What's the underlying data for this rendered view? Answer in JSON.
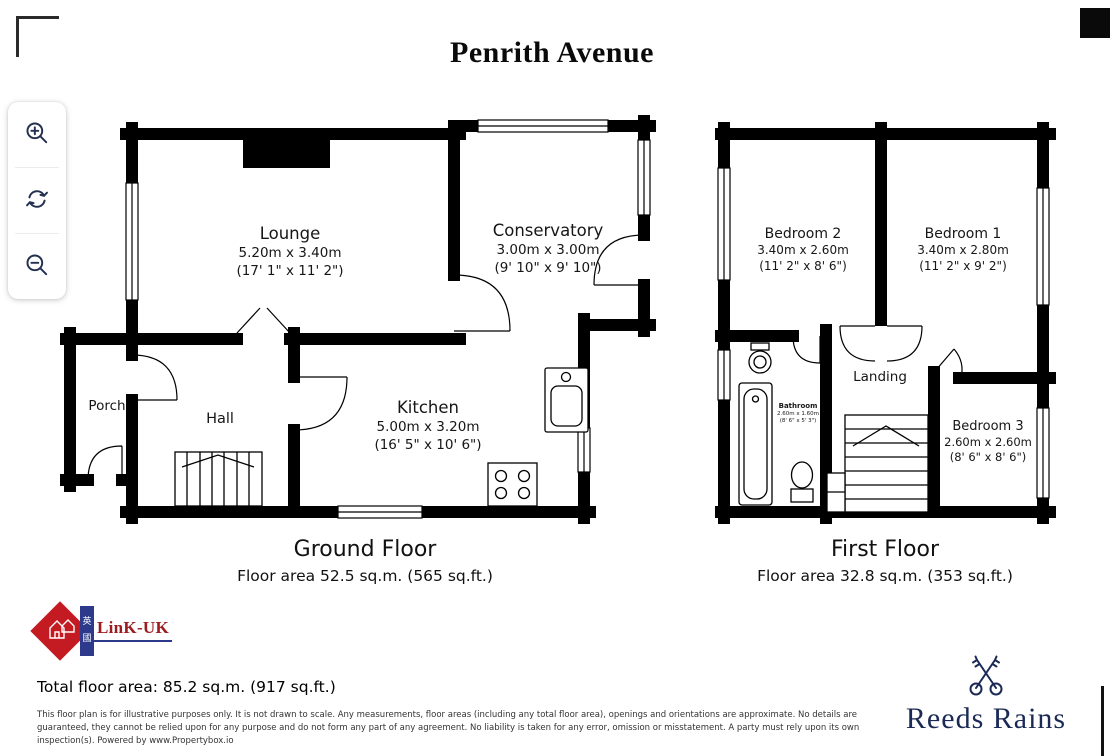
{
  "title": "Penrith Avenue",
  "toolbar": {
    "buttons": [
      {
        "name": "zoom-in"
      },
      {
        "name": "rotate"
      },
      {
        "name": "zoom-out"
      }
    ]
  },
  "ground_floor": {
    "caption": "Ground Floor",
    "area": "Floor area 52.5 sq.m. (565 sq.ft.)",
    "rooms": [
      {
        "name": "Lounge",
        "metric": "5.20m x 3.40m",
        "imperial": "(17' 1\" x 11' 2\")"
      },
      {
        "name": "Conservatory",
        "metric": "3.00m x 3.00m",
        "imperial": "(9' 10\" x 9' 10\")"
      },
      {
        "name": "Porch"
      },
      {
        "name": "Hall"
      },
      {
        "name": "Kitchen",
        "metric": "5.00m x 3.20m",
        "imperial": "(16' 5\" x 10' 6\")"
      }
    ]
  },
  "first_floor": {
    "caption": "First Floor",
    "area": "Floor area 32.8 sq.m. (353 sq.ft.)",
    "rooms": [
      {
        "name": "Bedroom 2",
        "metric": "3.40m x 2.60m",
        "imperial": "(11' 2\" x 8' 6\")"
      },
      {
        "name": "Bedroom 1",
        "metric": "3.40m x 2.80m",
        "imperial": "(11' 2\" x 9' 2\")"
      },
      {
        "name": "Landing"
      },
      {
        "name": "Bathroom",
        "metric": "2.60m x 1.60m",
        "imperial": "(8' 6\" x 5' 3\")"
      },
      {
        "name": "Bedroom 3",
        "metric": "2.60m x 2.60m",
        "imperial": "(8' 6\" x 8' 6\")"
      }
    ]
  },
  "footer": {
    "total_area": "Total floor area: 85.2 sq.m. (917 sq.ft.)",
    "disclaimer": "This floor plan is for illustrative purposes only. It is not drawn to scale. Any measurements, floor areas (including any total floor area), openings and orientations are approximate. No details are guaranteed, they cannot be relied upon for any purpose and do not form any part of any agreement. No liability is taken for any error, omission or misstatement. A party must rely upon its own inspection(s). Powered by www.Propertybox.io"
  },
  "logos": {
    "link_uk": {
      "text": "LinK-UK",
      "cn_top": "英",
      "cn_bottom": "國"
    },
    "reeds_rains": {
      "text": "Reeds Rains"
    }
  },
  "colors": {
    "walls": "#000000",
    "toolbar_icon": "#233050",
    "linkuk_red": "#c41a21",
    "linkuk_blue": "#2d3a8c",
    "linkuk_text": "#9d1c20",
    "reeds_navy": "#1b2a55"
  }
}
